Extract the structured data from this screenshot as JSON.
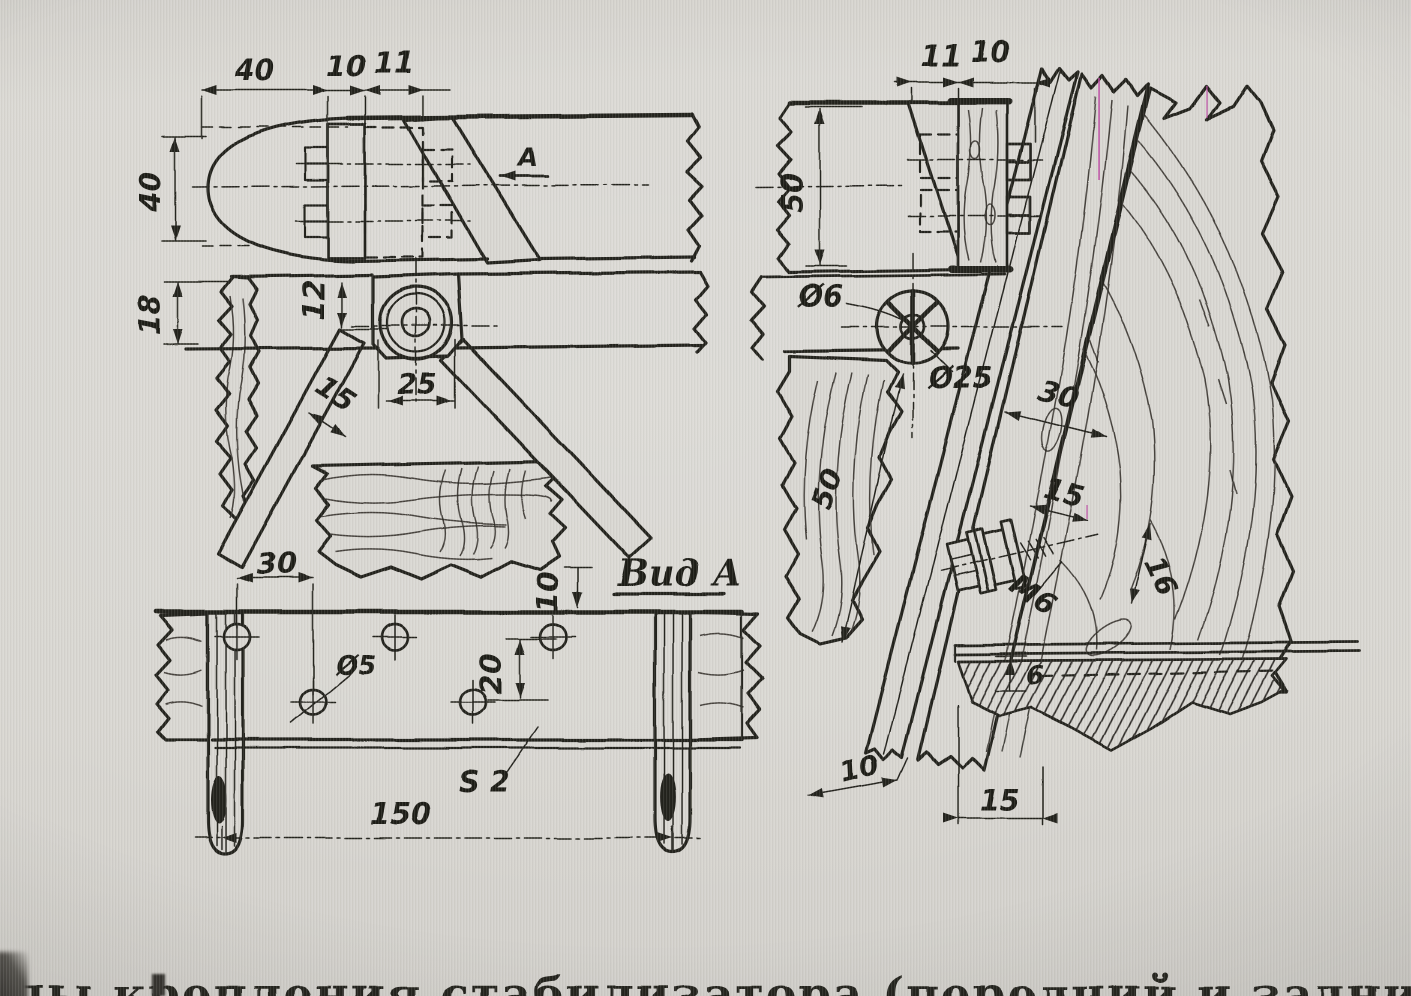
{
  "caption": {
    "text": "Узлы крепления стабилизатора (передний и задний)"
  },
  "left_view": {
    "dims": {
      "top_40": "40",
      "top_10": "10",
      "top_11": "11",
      "left_40": "40",
      "left_18": "18",
      "inner_12": "12",
      "pivot_25": "25",
      "strut_15": "15"
    },
    "view_arrow": "А"
  },
  "right_view": {
    "dims": {
      "top_11": "11",
      "top_10": "10",
      "left_50": "50",
      "hole_dia": "Ø6",
      "pivot_dia": "Ø25",
      "planks_30": "30",
      "plank_15": "15",
      "bolt_16": "16",
      "thread": "М6",
      "diag_50": "50",
      "strip_6": "6",
      "bottom_10": "10",
      "bottom_15": "15"
    }
  },
  "bottom_view": {
    "title": "Вид А",
    "dims": {
      "spacing_30": "30",
      "edge_10": "10",
      "rows_20": "20",
      "hole_dia": "Ø5",
      "thickness": "S 2",
      "span_150": "150"
    }
  },
  "colors": {
    "paper": "#d9d7d2",
    "ink": "#24211d",
    "artifact_magenta": "#ba3ea0"
  }
}
